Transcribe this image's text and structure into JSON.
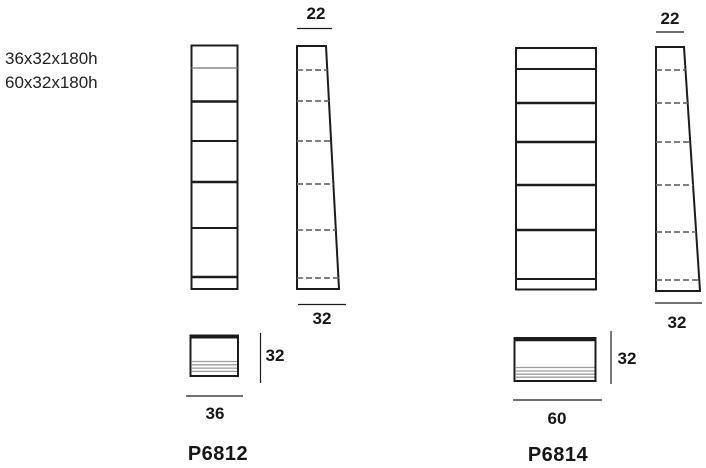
{
  "sheet": {
    "background": "#ffffff",
    "ink_color": "#1c1c1c",
    "gray_line_color": "#9b9b9b",
    "dash_line_color": "#6e6e6e"
  },
  "spec": {
    "lines": [
      "36x32x180h",
      "60x32x180h"
    ]
  },
  "products": [
    {
      "code": "P6812",
      "dim_top_width": "22",
      "dim_side_depth": "32",
      "dim_plan_depth": "32",
      "dim_plan_width": "36"
    },
    {
      "code": "P6814",
      "dim_top_width": "22",
      "dim_side_depth": "32",
      "dim_plan_depth": "32",
      "dim_plan_width": "60"
    }
  ]
}
